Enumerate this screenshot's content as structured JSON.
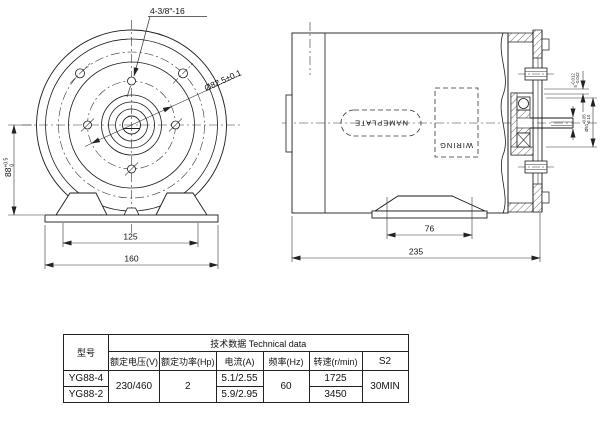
{
  "front_view": {
    "thread_callout": "4-3/8\"-16",
    "bolt_circle_dim": "Ø82.5±0.1",
    "center_height": {
      "value": "88",
      "tol_upper": "+0.5",
      "tol_lower": "0"
    },
    "foot_hole_spacing": "125",
    "base_width": "160"
  },
  "side_view": {
    "nameplate_label": "NAMEPLATE",
    "wiring_label": "WIRING",
    "foot_length": "76",
    "overall_length": "235",
    "keyway_width": {
      "value": "5",
      "tol_upper": "-0.012",
      "tol_lower": "-0.042"
    },
    "hub_diameter": {
      "value": "Ø51",
      "tol_upper": "-0.05",
      "tol_lower": "-0.10"
    }
  },
  "table": {
    "title": "技术数据 Technical data",
    "model_header": "型号",
    "columns": [
      "额定电压(V)",
      "额定功率(Hp)",
      "电流(A)",
      "频率(Hz)",
      "转速(r/min)",
      "S2"
    ],
    "row1_model": "YG88-4",
    "row2_model": "YG88-2",
    "voltage": "230/460",
    "power": "2",
    "current_row1": "5.1/2.55",
    "current_row2": "5.9/2.95",
    "frequency": "60",
    "speed_row1": "1725",
    "speed_row2": "3450",
    "duty": "30MIN"
  }
}
